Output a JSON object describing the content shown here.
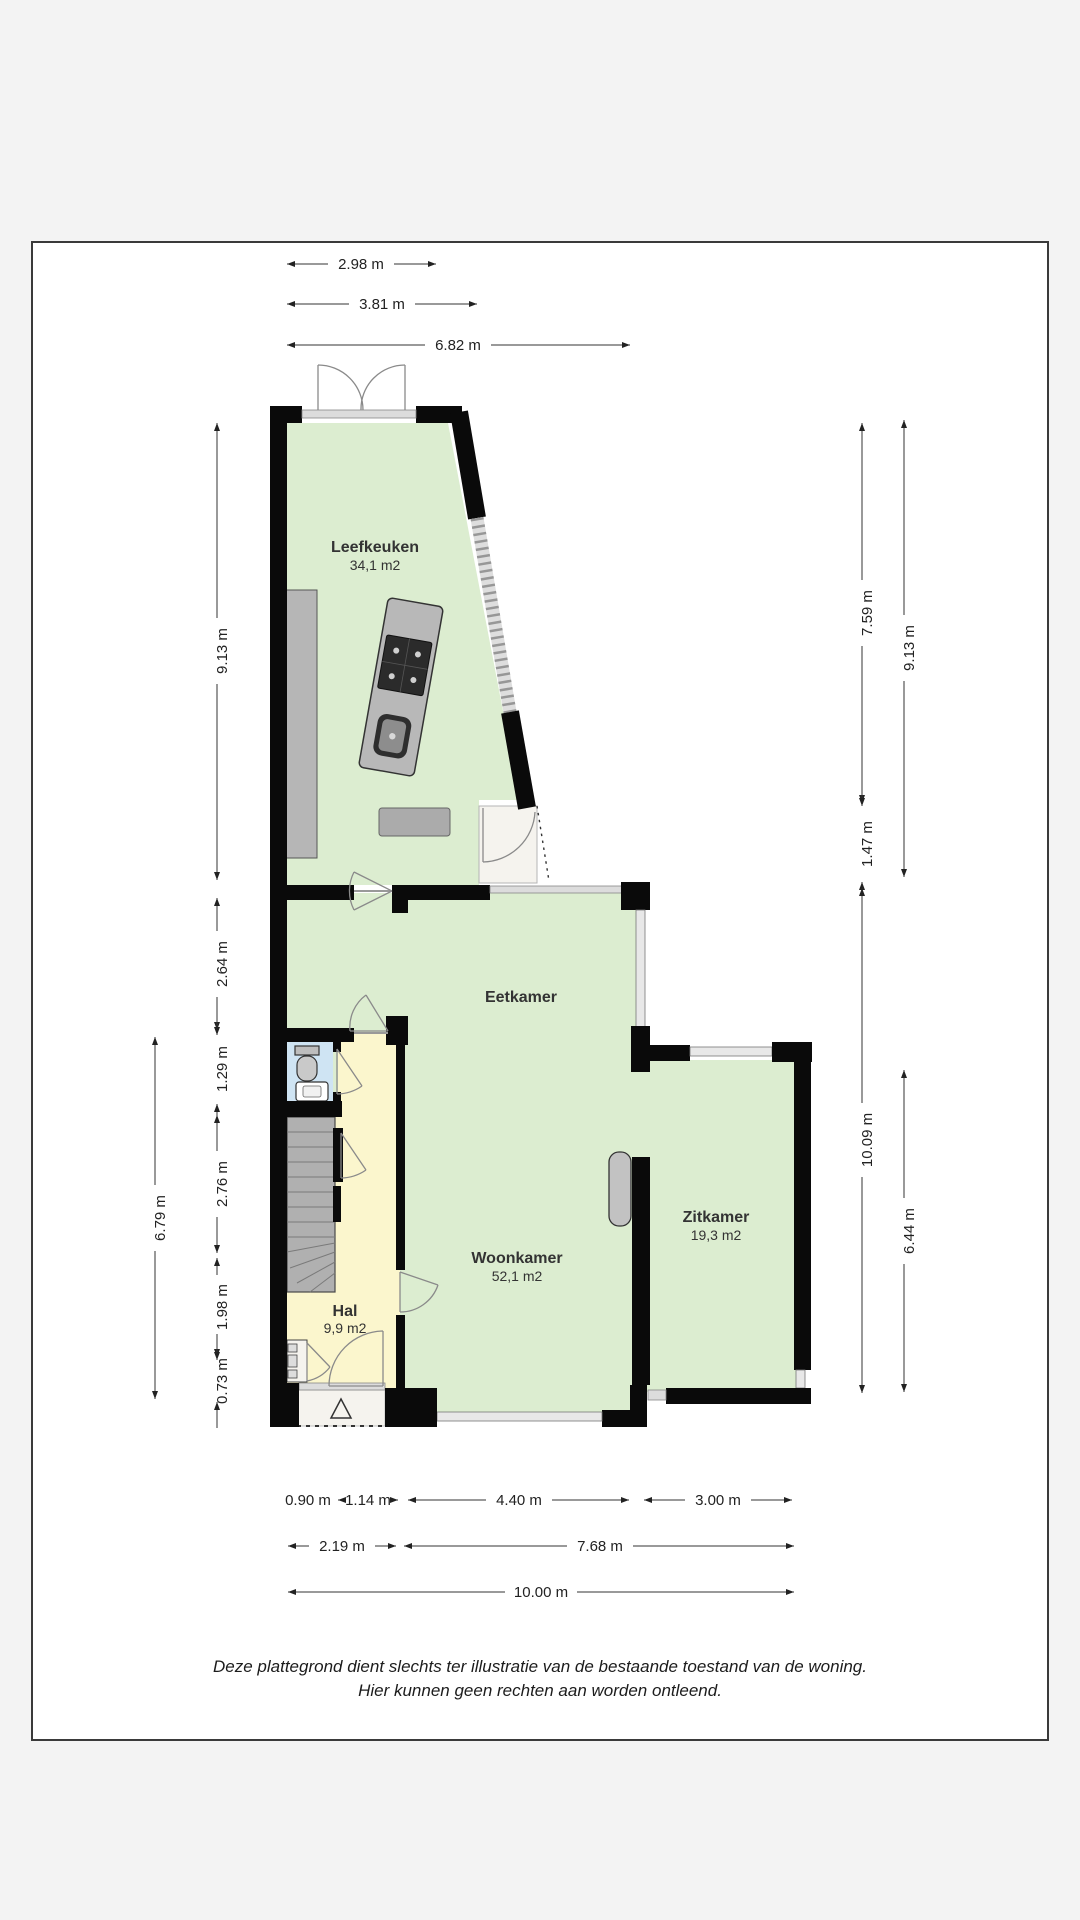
{
  "document": {
    "disclaimer": [
      "Deze plattegrond dient slechts ter illustratie van de bestaande toestand van de woning.",
      "Hier kunnen geen rechten aan worden ontleend."
    ]
  },
  "rooms": {
    "leefkeuken": {
      "name": "Leefkeuken",
      "area": "34,1 m2"
    },
    "eetkamer": {
      "name": "Eetkamer"
    },
    "woonkamer": {
      "name": "Woonkamer",
      "area": "52,1 m2"
    },
    "zitkamer": {
      "name": "Zitkamer",
      "area": "19,3 m2"
    },
    "hal": {
      "name": "Hal",
      "area": "9,9 m2"
    }
  },
  "dimensions": {
    "top": [
      "2.98 m",
      "3.81 m",
      "6.82 m"
    ],
    "left_inner": [
      "9.13 m",
      "2.64 m",
      "1.29 m",
      "2.76 m",
      "1.98 m",
      "0.73 m"
    ],
    "left_outer": [
      "6.79 m"
    ],
    "right_inner": [
      "7.59 m",
      "1.47 m",
      "10.09 m"
    ],
    "right_outer": [
      "9.13 m",
      "6.44 m"
    ],
    "bottom_row1": [
      "0.90 m",
      "1.14 m",
      "4.40 m",
      "3.00 m"
    ],
    "bottom_row2": [
      "2.19 m",
      "7.68 m"
    ],
    "bottom_row3": [
      "10.00 m"
    ]
  },
  "colors": {
    "floor_green": "#dcedd0",
    "hall_yellow": "#fbf6cd",
    "wc_blue": "#cfe4f3",
    "wall_black": "#0a0a0a",
    "counter_gray": "#b8b8b8",
    "porch_white": "#f5f3ee"
  }
}
